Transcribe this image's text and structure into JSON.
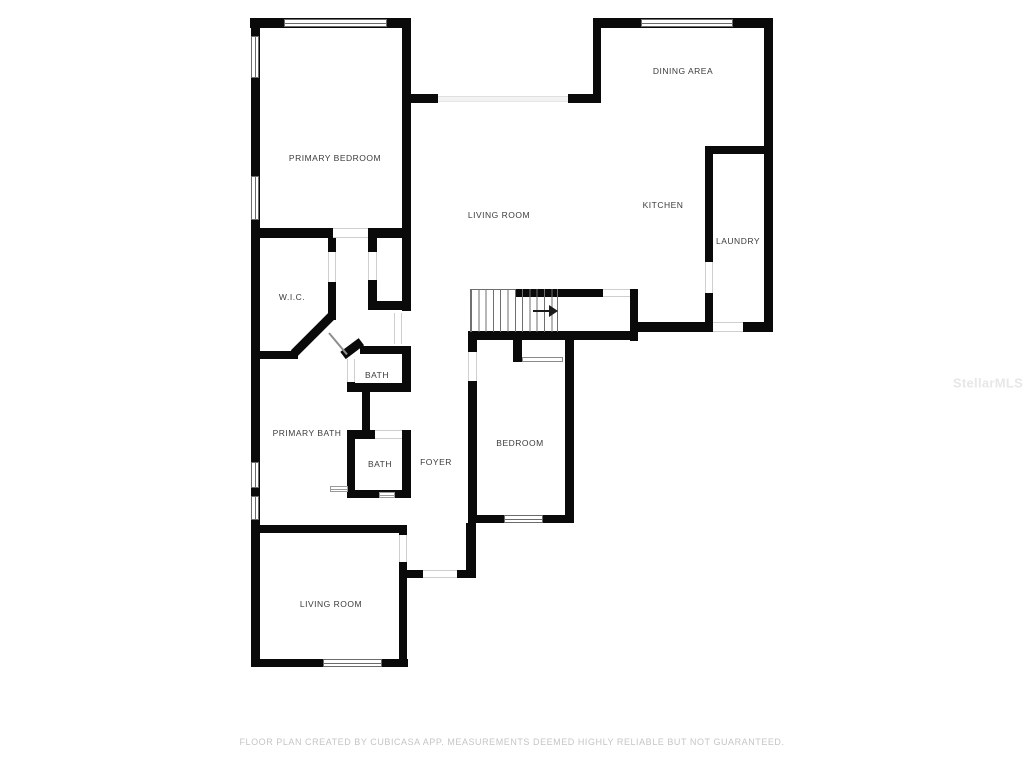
{
  "labels": {
    "primary_bedroom": "PRIMARY BEDROOM",
    "living_room_main": "LIVING ROOM",
    "dining_area": "DINING AREA",
    "kitchen": "KITCHEN",
    "laundry": "LAUNDRY",
    "wic": "W.I.C.",
    "bath_upper": "BATH",
    "primary_bath": "PRIMARY BATH",
    "bath_lower": "BATH",
    "foyer": "FOYER",
    "bedroom": "BEDROOM",
    "living_room_lower": "LIVING ROOM"
  },
  "watermark": "StellarMLS",
  "footer": {
    "disclaimer": "FLOOR PLAN CREATED BY CUBICASA APP. MEASUREMENTS DEEMED HIGHLY RELIABLE BUT NOT GUARANTEED."
  },
  "colors": {
    "wall": "#0a0a0a",
    "label_text": "#3b3b3b",
    "footer_text": "#c5c5c5",
    "watermark": "#e7e7e7"
  }
}
